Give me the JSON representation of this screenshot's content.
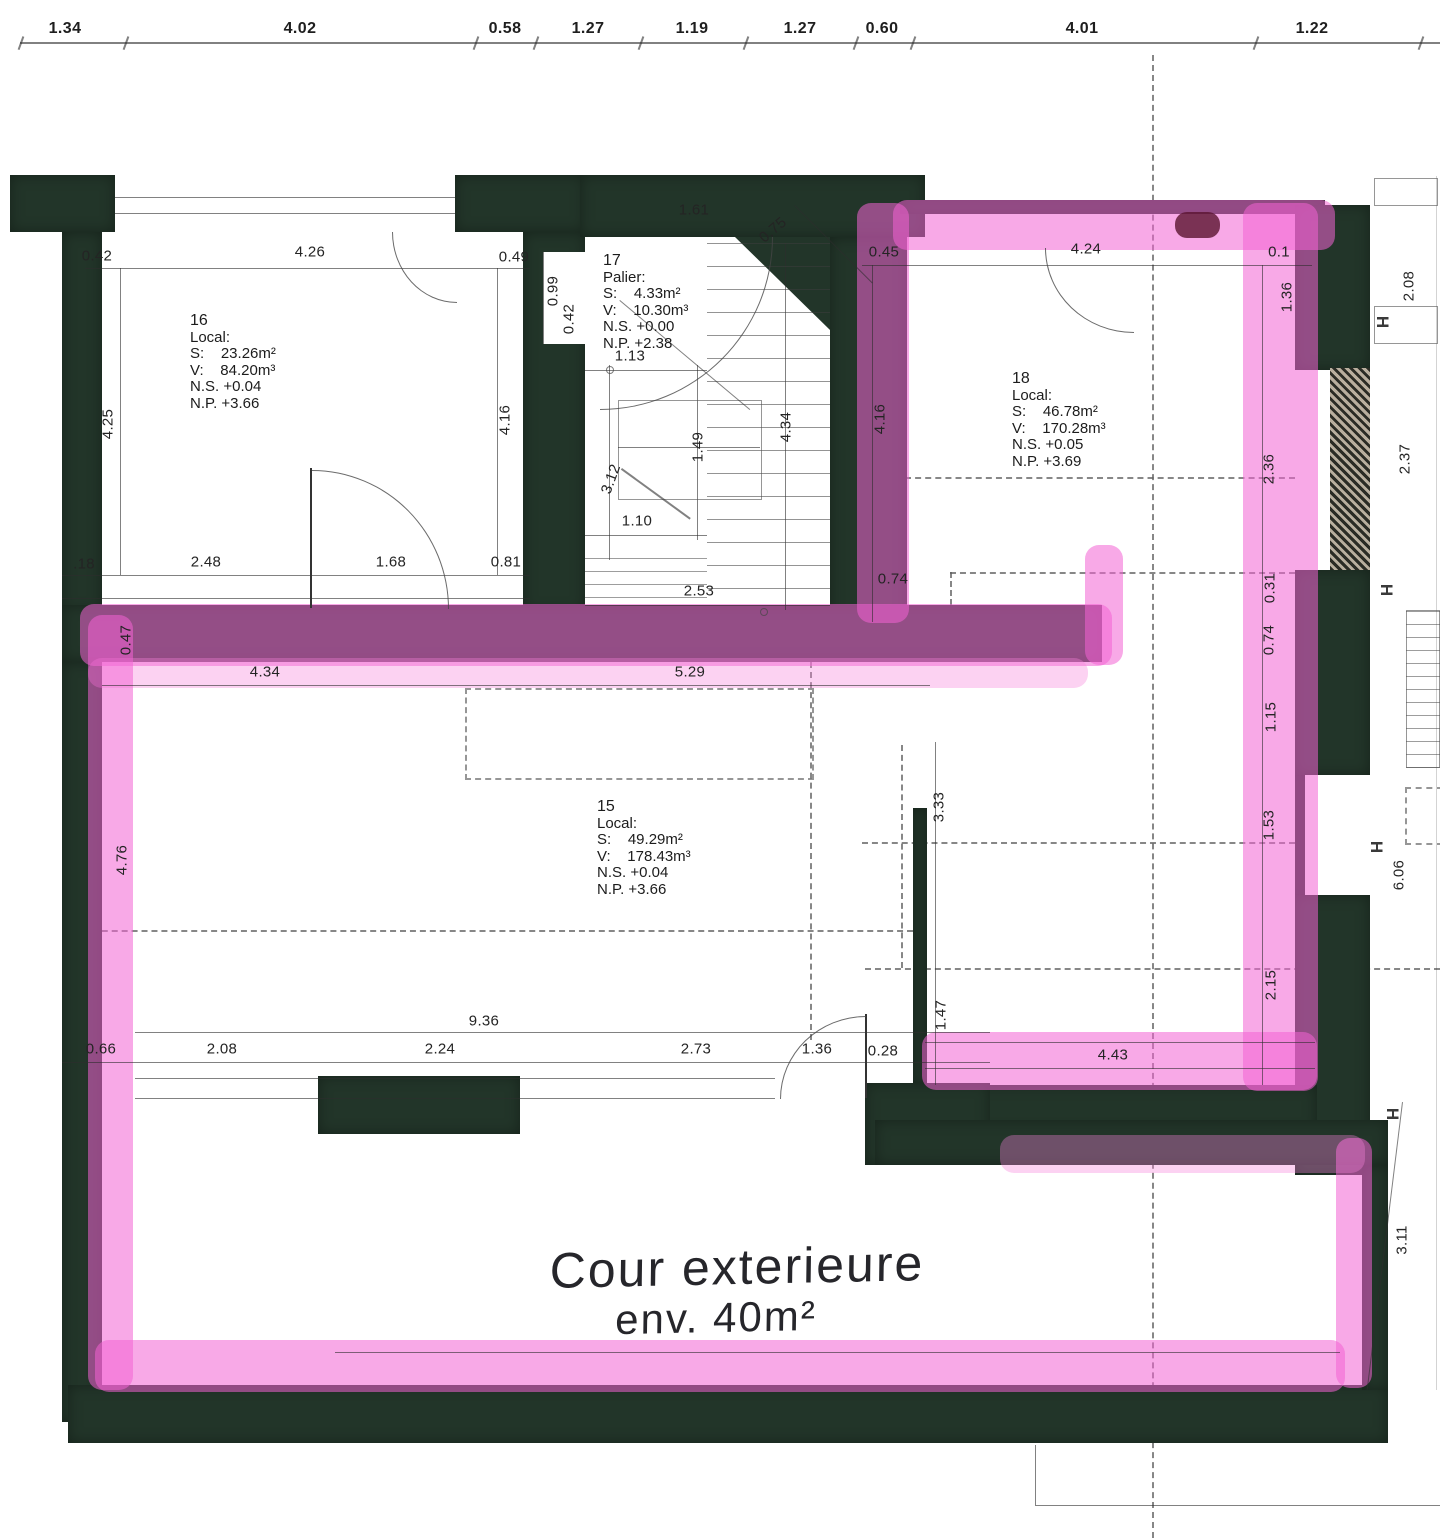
{
  "document": {
    "kind": "scanned architectural floor plan with pink highlighter annotations",
    "floor_note": "rooms 15, 16, 17, 18 and exterior courtyard"
  },
  "colors": {
    "wall_ink": "#223529",
    "highlighter_pink": "#f362d3",
    "paper": "#ffffff",
    "line_ink": "#2d2d2d"
  },
  "ruler": {
    "values": [
      {
        "t": "1.34",
        "x": 65
      },
      {
        "t": "4.02",
        "x": 300
      },
      {
        "t": "0.58",
        "x": 505
      },
      {
        "t": "1.27",
        "x": 588
      },
      {
        "t": "1.19",
        "x": 692
      },
      {
        "t": "1.27",
        "x": 800
      },
      {
        "t": "0.60",
        "x": 882
      },
      {
        "t": "4.01",
        "x": 1082
      },
      {
        "t": "1.22",
        "x": 1312
      }
    ]
  },
  "rooms": [
    {
      "x": 190,
      "y": 312,
      "lines": [
        "16",
        "Local:",
        "S:    23.26m²",
        "V:    84.20m³",
        "N.S. +0.04",
        "N.P. +3.66"
      ]
    },
    {
      "x": 603,
      "y": 252,
      "lines": [
        "17",
        "Palier:",
        "S:    4.33m²",
        "V:    10.30m³",
        "N.S. +0.00",
        "N.P. +2.38"
      ]
    },
    {
      "x": 1012,
      "y": 370,
      "lines": [
        "18",
        "Local:",
        "S:    46.78m²",
        "V:    170.28m³",
        "N.S. +0.05",
        "N.P. +3.69"
      ]
    },
    {
      "x": 597,
      "y": 798,
      "lines": [
        "15",
        "Local:",
        "S:    49.29m²",
        "V:    178.43m³",
        "N.S. +0.04",
        "N.P. +3.66"
      ]
    }
  ],
  "dimensions": [
    {
      "t": "0.42",
      "x": 97,
      "y": 256,
      "r": 0
    },
    {
      "t": "4.26",
      "x": 310,
      "y": 252,
      "r": 0
    },
    {
      "t": "0.49",
      "x": 514,
      "y": 257,
      "r": 0
    },
    {
      "t": "4.25",
      "x": 108,
      "y": 424,
      "r": -90
    },
    {
      "t": "4.16",
      "x": 505,
      "y": 420,
      "r": -90
    },
    {
      "t": ".18",
      "x": 84,
      "y": 564,
      "r": 0
    },
    {
      "t": "2.48",
      "x": 206,
      "y": 562,
      "r": 0
    },
    {
      "t": "1.68",
      "x": 391,
      "y": 562,
      "r": 0
    },
    {
      "t": "0.81",
      "x": 506,
      "y": 562,
      "r": 0
    },
    {
      "t": "1.61",
      "x": 694,
      "y": 210,
      "r": 0
    },
    {
      "t": "0.75",
      "x": 773,
      "y": 230,
      "r": -40
    },
    {
      "t": "0.99",
      "x": 553,
      "y": 291,
      "r": -90
    },
    {
      "t": "0.42",
      "x": 569,
      "y": 319,
      "r": -90
    },
    {
      "t": "1.13",
      "x": 630,
      "y": 356,
      "r": 0
    },
    {
      "t": "1.49",
      "x": 698,
      "y": 447,
      "r": -90
    },
    {
      "t": "3.12",
      "x": 611,
      "y": 479,
      "r": -70
    },
    {
      "t": "1.10",
      "x": 637,
      "y": 521,
      "r": 0
    },
    {
      "t": "4.34",
      "x": 786,
      "y": 427,
      "r": -90
    },
    {
      "t": "2.53",
      "x": 699,
      "y": 591,
      "r": 0
    },
    {
      "t": "0.74",
      "x": 893,
      "y": 579,
      "r": 0
    },
    {
      "t": "0.45",
      "x": 884,
      "y": 252,
      "r": 0
    },
    {
      "t": "4.24",
      "x": 1086,
      "y": 249,
      "r": 0
    },
    {
      "t": "0.1",
      "x": 1279,
      "y": 252,
      "r": 0
    },
    {
      "t": "1.36",
      "x": 1287,
      "y": 297,
      "r": -90
    },
    {
      "t": "4.16",
      "x": 880,
      "y": 419,
      "r": -90
    },
    {
      "t": "2.36",
      "x": 1269,
      "y": 469,
      "r": -90
    },
    {
      "t": "0.31",
      "x": 1270,
      "y": 588,
      "r": -90
    },
    {
      "t": "0.74",
      "x": 1269,
      "y": 640,
      "r": -90
    },
    {
      "t": "1.15",
      "x": 1271,
      "y": 717,
      "r": -90
    },
    {
      "t": "1.53",
      "x": 1269,
      "y": 825,
      "r": -90
    },
    {
      "t": "2.15",
      "x": 1271,
      "y": 985,
      "r": -90
    },
    {
      "t": "3.33",
      "x": 939,
      "y": 807,
      "r": -90
    },
    {
      "t": "1.47",
      "x": 941,
      "y": 1015,
      "r": -90
    },
    {
      "t": "4.43",
      "x": 1113,
      "y": 1055,
      "r": 0
    },
    {
      "t": "2.08",
      "x": 1409,
      "y": 286,
      "r": -90
    },
    {
      "t": "2.37",
      "x": 1405,
      "y": 459,
      "r": -90
    },
    {
      "t": "6.06",
      "x": 1399,
      "y": 875,
      "r": -90
    },
    {
      "t": "3.11",
      "x": 1402,
      "y": 1240,
      "r": -90
    },
    {
      "t": "0.47",
      "x": 126,
      "y": 640,
      "r": -90
    },
    {
      "t": "4.34",
      "x": 265,
      "y": 672,
      "r": 0
    },
    {
      "t": "5.29",
      "x": 690,
      "y": 672,
      "r": 0
    },
    {
      "t": "4.76",
      "x": 122,
      "y": 860,
      "r": -90
    },
    {
      "t": "9.36",
      "x": 484,
      "y": 1021,
      "r": 0
    },
    {
      "t": "0.66",
      "x": 101,
      "y": 1049,
      "r": 0
    },
    {
      "t": "2.08",
      "x": 222,
      "y": 1049,
      "r": 0
    },
    {
      "t": "2.24",
      "x": 440,
      "y": 1049,
      "r": 0
    },
    {
      "t": "2.73",
      "x": 696,
      "y": 1049,
      "r": 0
    },
    {
      "t": "1.36",
      "x": 817,
      "y": 1049,
      "r": 0
    },
    {
      "t": "0.28",
      "x": 883,
      "y": 1051,
      "r": 0
    }
  ],
  "handwriting": {
    "line1": "Cour exterieure",
    "line2": "env. 40m²"
  },
  "symbols": {
    "ibeam": "H"
  }
}
